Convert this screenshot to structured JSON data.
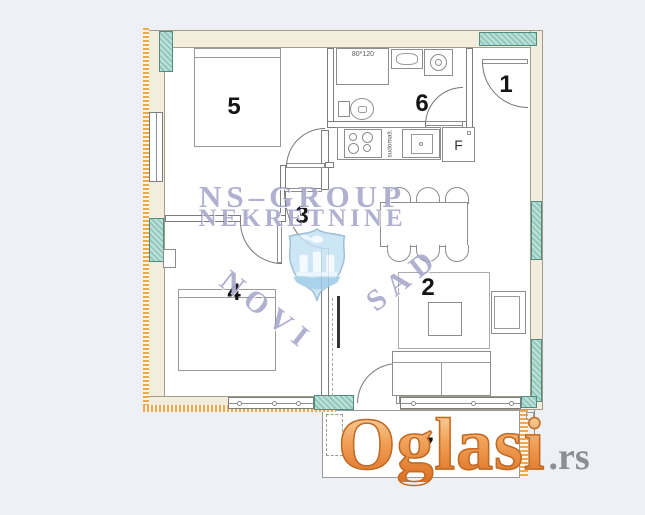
{
  "page": {
    "background": "#edf1f5"
  },
  "floorplan": {
    "rooms": [
      {
        "number": "1"
      },
      {
        "number": "2"
      },
      {
        "number": "3"
      },
      {
        "number": "4"
      },
      {
        "number": "5"
      },
      {
        "number": "6"
      },
      {
        "number": "7"
      }
    ],
    "labels": {
      "shower_dimensions": "80*120",
      "dishwasher": "sudomaš.",
      "fridge": "F"
    },
    "colors": {
      "wall_fill": "#f3edde",
      "window_marker_teal": "#93c9bd",
      "insulation_orange": "#f0a84e",
      "line_gray": "#7c7c7c"
    }
  },
  "watermark": {
    "agency_line1": "NS–GROUP",
    "agency_line2": "NEKRETNINE",
    "city_word1": "NOVI",
    "city_word2": "SAD",
    "color": "#8c8cc0"
  },
  "site_logo": {
    "name": "Oglasi",
    "domain_suffix": ".rs",
    "orange": "#e8913f",
    "gray": "#8b8e93"
  }
}
